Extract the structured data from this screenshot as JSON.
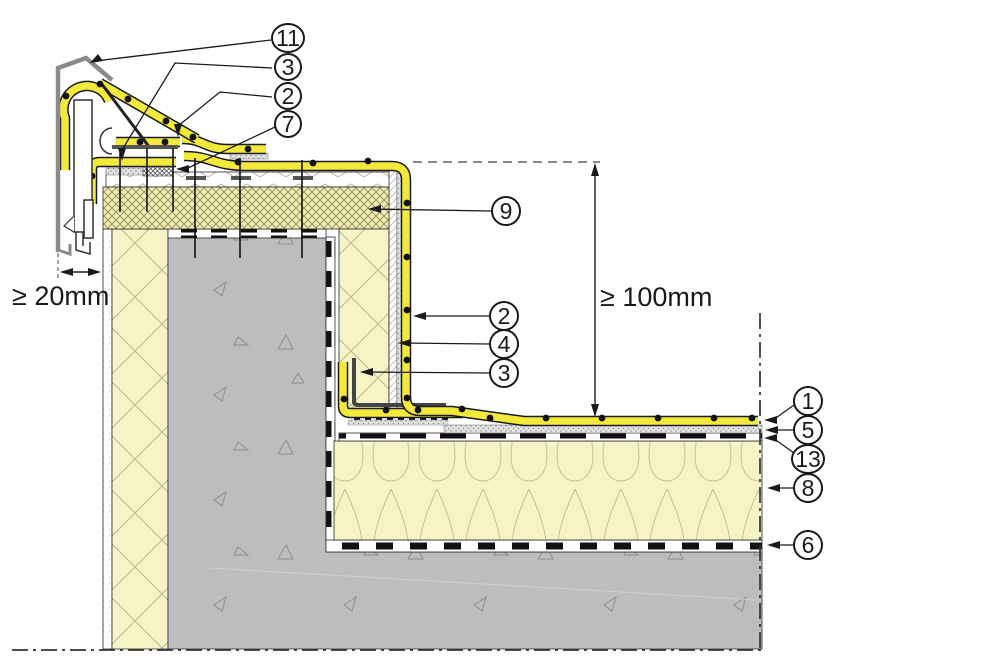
{
  "callouts": {
    "top_left": [
      {
        "label": "11"
      },
      {
        "label": "3"
      },
      {
        "label": "2"
      },
      {
        "label": "7"
      }
    ],
    "middle": [
      {
        "label": "9"
      },
      {
        "label": "2"
      },
      {
        "label": "4"
      },
      {
        "label": "3"
      }
    ],
    "right": [
      {
        "label": "1"
      },
      {
        "label": "5"
      },
      {
        "label": "13"
      },
      {
        "label": "8"
      },
      {
        "label": "6"
      }
    ]
  },
  "dimensions": {
    "parapet_gap": "≥ 20mm",
    "upstand_height": "≥ 100mm"
  },
  "colors": {
    "membrane_yellow": "#f2e93b",
    "insulation_pale": "#f6f3c6",
    "hatch_insulation_bg": "#f0ecb0",
    "concrete_gray": "#bdbdbd",
    "coping_gray": "#8a8a8a",
    "line_black": "#1a1a1a"
  }
}
